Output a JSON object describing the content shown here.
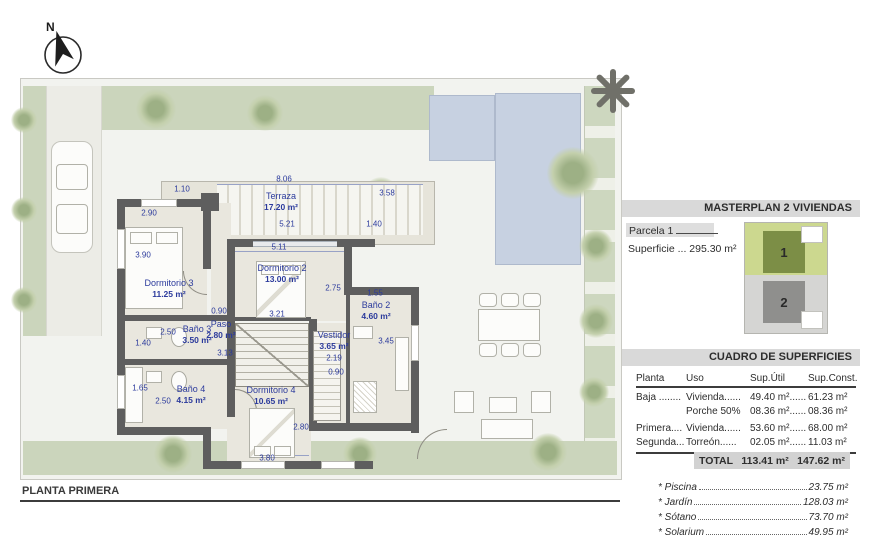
{
  "north": {
    "label": "N"
  },
  "plan": {
    "title": "PLANTA PRIMERA",
    "rooms": {
      "terraza": {
        "name": "Terraza",
        "area": "17.20 m²"
      },
      "dorm3": {
        "name": "Dormitorio 3",
        "area": "11.25 m²"
      },
      "dorm2": {
        "name": "Dormitorio 2",
        "area": "13.00 m²"
      },
      "bano3": {
        "name": "Baño 3",
        "area": "3.50 m²"
      },
      "paso": {
        "name": "Paso",
        "area": "2.80 m²"
      },
      "bano2": {
        "name": "Baño 2",
        "area": "4.60 m²"
      },
      "vestidor": {
        "name": "Vestidor",
        "area": "3.65 m²"
      },
      "bano4": {
        "name": "Baño 4",
        "area": "4.15 m²"
      },
      "dorm4": {
        "name": "Dormitorio 4",
        "area": "10.65 m²"
      }
    },
    "dims": {
      "v110": "1.10",
      "v806": "8.06",
      "v358": "3.58",
      "v521": "5.21",
      "v140a": "1.40",
      "v290": "2.90",
      "v511": "5.11",
      "v390": "3.90",
      "v275": "2.75",
      "v155": "1.55",
      "v090a": "0.90",
      "v321": "3.21",
      "v250a": "2.50",
      "v140b": "1.40",
      "v313": "3.13",
      "v345": "3.45",
      "v219": "2.19",
      "v090b": "0.90",
      "v165": "1.65",
      "v250b": "2.50",
      "v280": "2.80",
      "v380": "3.80"
    }
  },
  "panel": {
    "masterplan_title": "MASTERPLAN 2 VIVIENDAS",
    "parcela": "Parcela 1",
    "superficie": "Superficie ... 295.30 m²",
    "sitemap": {
      "plot1": "1",
      "plot2": "2"
    },
    "cuadro_title": "CUADRO DE SUPERFICIES",
    "table": {
      "headers": [
        "Planta",
        "Uso",
        "Sup.Útil",
        "Sup.Const."
      ],
      "rows": [
        [
          "Baja ........",
          "Vivienda......",
          "49.40 m²......",
          "61.23 m²"
        ],
        [
          "",
          "Porche 50%",
          "08.36 m²......",
          "08.36 m²"
        ],
        [
          "Primera....",
          "Vivienda......",
          "53.60 m²......",
          "68.00 m²"
        ],
        [
          "Segunda...",
          "Torreón......",
          "02.05 m²......",
          "11.03 m²"
        ]
      ],
      "total_label": "TOTAL",
      "total_util": "113.41 m²",
      "total_const": "147.62 m²"
    },
    "extras": [
      {
        "label": "* Piscina",
        "value": "23.75 m²"
      },
      {
        "label": "* Jardín",
        "value": "128.03 m²"
      },
      {
        "label": "* Sótano",
        "value": "73.70 m²"
      },
      {
        "label": "* Solarium",
        "value": "49.95 m²"
      }
    ]
  },
  "colors": {
    "label_blue": "#2b3a9c",
    "wall_gray": "#5e5e5e",
    "grass_green": "#cbd5bc",
    "pool_blue": "#c7d1e1",
    "bar_gray": "#d9d9d9",
    "map_green": "#ccd88f",
    "map_house1": "#7c8e46",
    "map_gray": "#d5d5d3",
    "map_house2": "#8f8f8d"
  }
}
